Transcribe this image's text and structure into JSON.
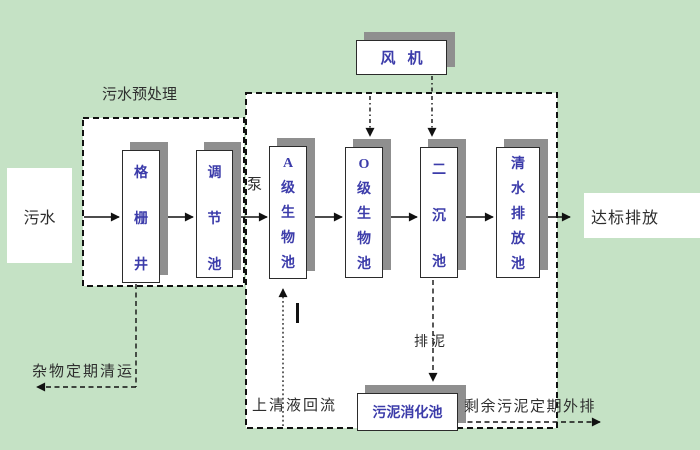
{
  "title": "污水处理工艺流程图",
  "colors": {
    "background": "#c5e2c5",
    "tank_text": "#3c3caa",
    "label_text": "#2e2e2e",
    "box_shadow": "#8f8f8f",
    "box_fill": "#ffffff",
    "line": "#111111"
  },
  "boxes": {
    "blower": "风机",
    "grid_well": "格栅井",
    "regulating_tank": "调节池",
    "a_bio_tank": "A级生物池",
    "o_bio_tank": "O级生物池",
    "secondary_sedimentation_tank": "二沉池",
    "clear_water_discharge_tank": "清水排放池",
    "sludge_digestion_tank": "污泥消化池"
  },
  "labels": {
    "influent": "污水",
    "pretreatment_zone": "污水预处理",
    "pump": "泵",
    "effluent": "达标排放",
    "debris_removal": "杂物定期清运",
    "supernatant_return": "上清液回流",
    "sludge_discharge": "排泥",
    "excess_sludge_discharge": "剩余污泥定期外排"
  }
}
